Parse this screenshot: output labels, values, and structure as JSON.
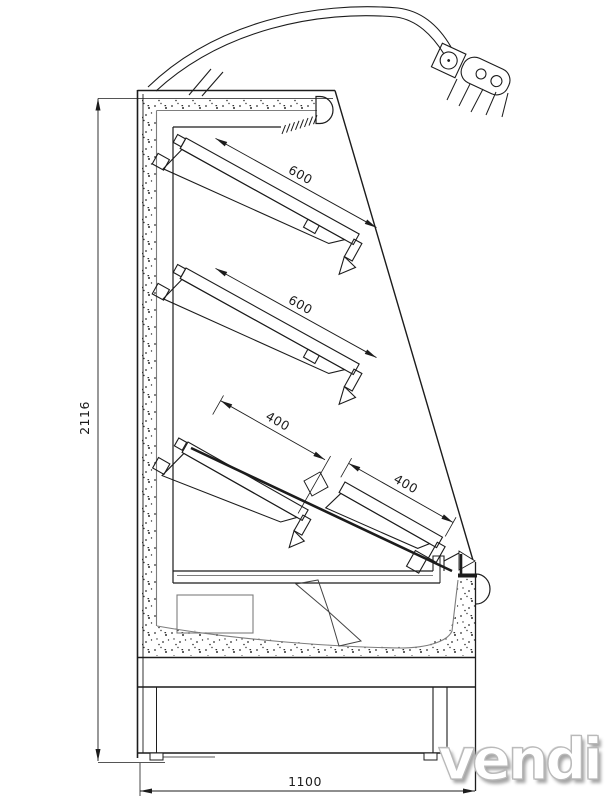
{
  "drawing": {
    "description": "Technical side-section drawing of an open-front refrigerated multideck display cabinet with curved light canopy, four tilted shelves, fan and base plinth"
  },
  "labels": {
    "height_mm": "2116",
    "depth_mm": "1100",
    "shelves": [
      "600",
      "600",
      "400",
      "400"
    ],
    "watermark": "vendi"
  },
  "colors": {
    "line": "#1c1c1c",
    "secondary_line": "#7d7d7d",
    "stipple_dot": "#2f2f2f",
    "background": "#ffffff",
    "watermark_fill": "#ffffff",
    "watermark_outline": "#b9b9b9",
    "watermark_shadow": "#a6a6a6"
  }
}
